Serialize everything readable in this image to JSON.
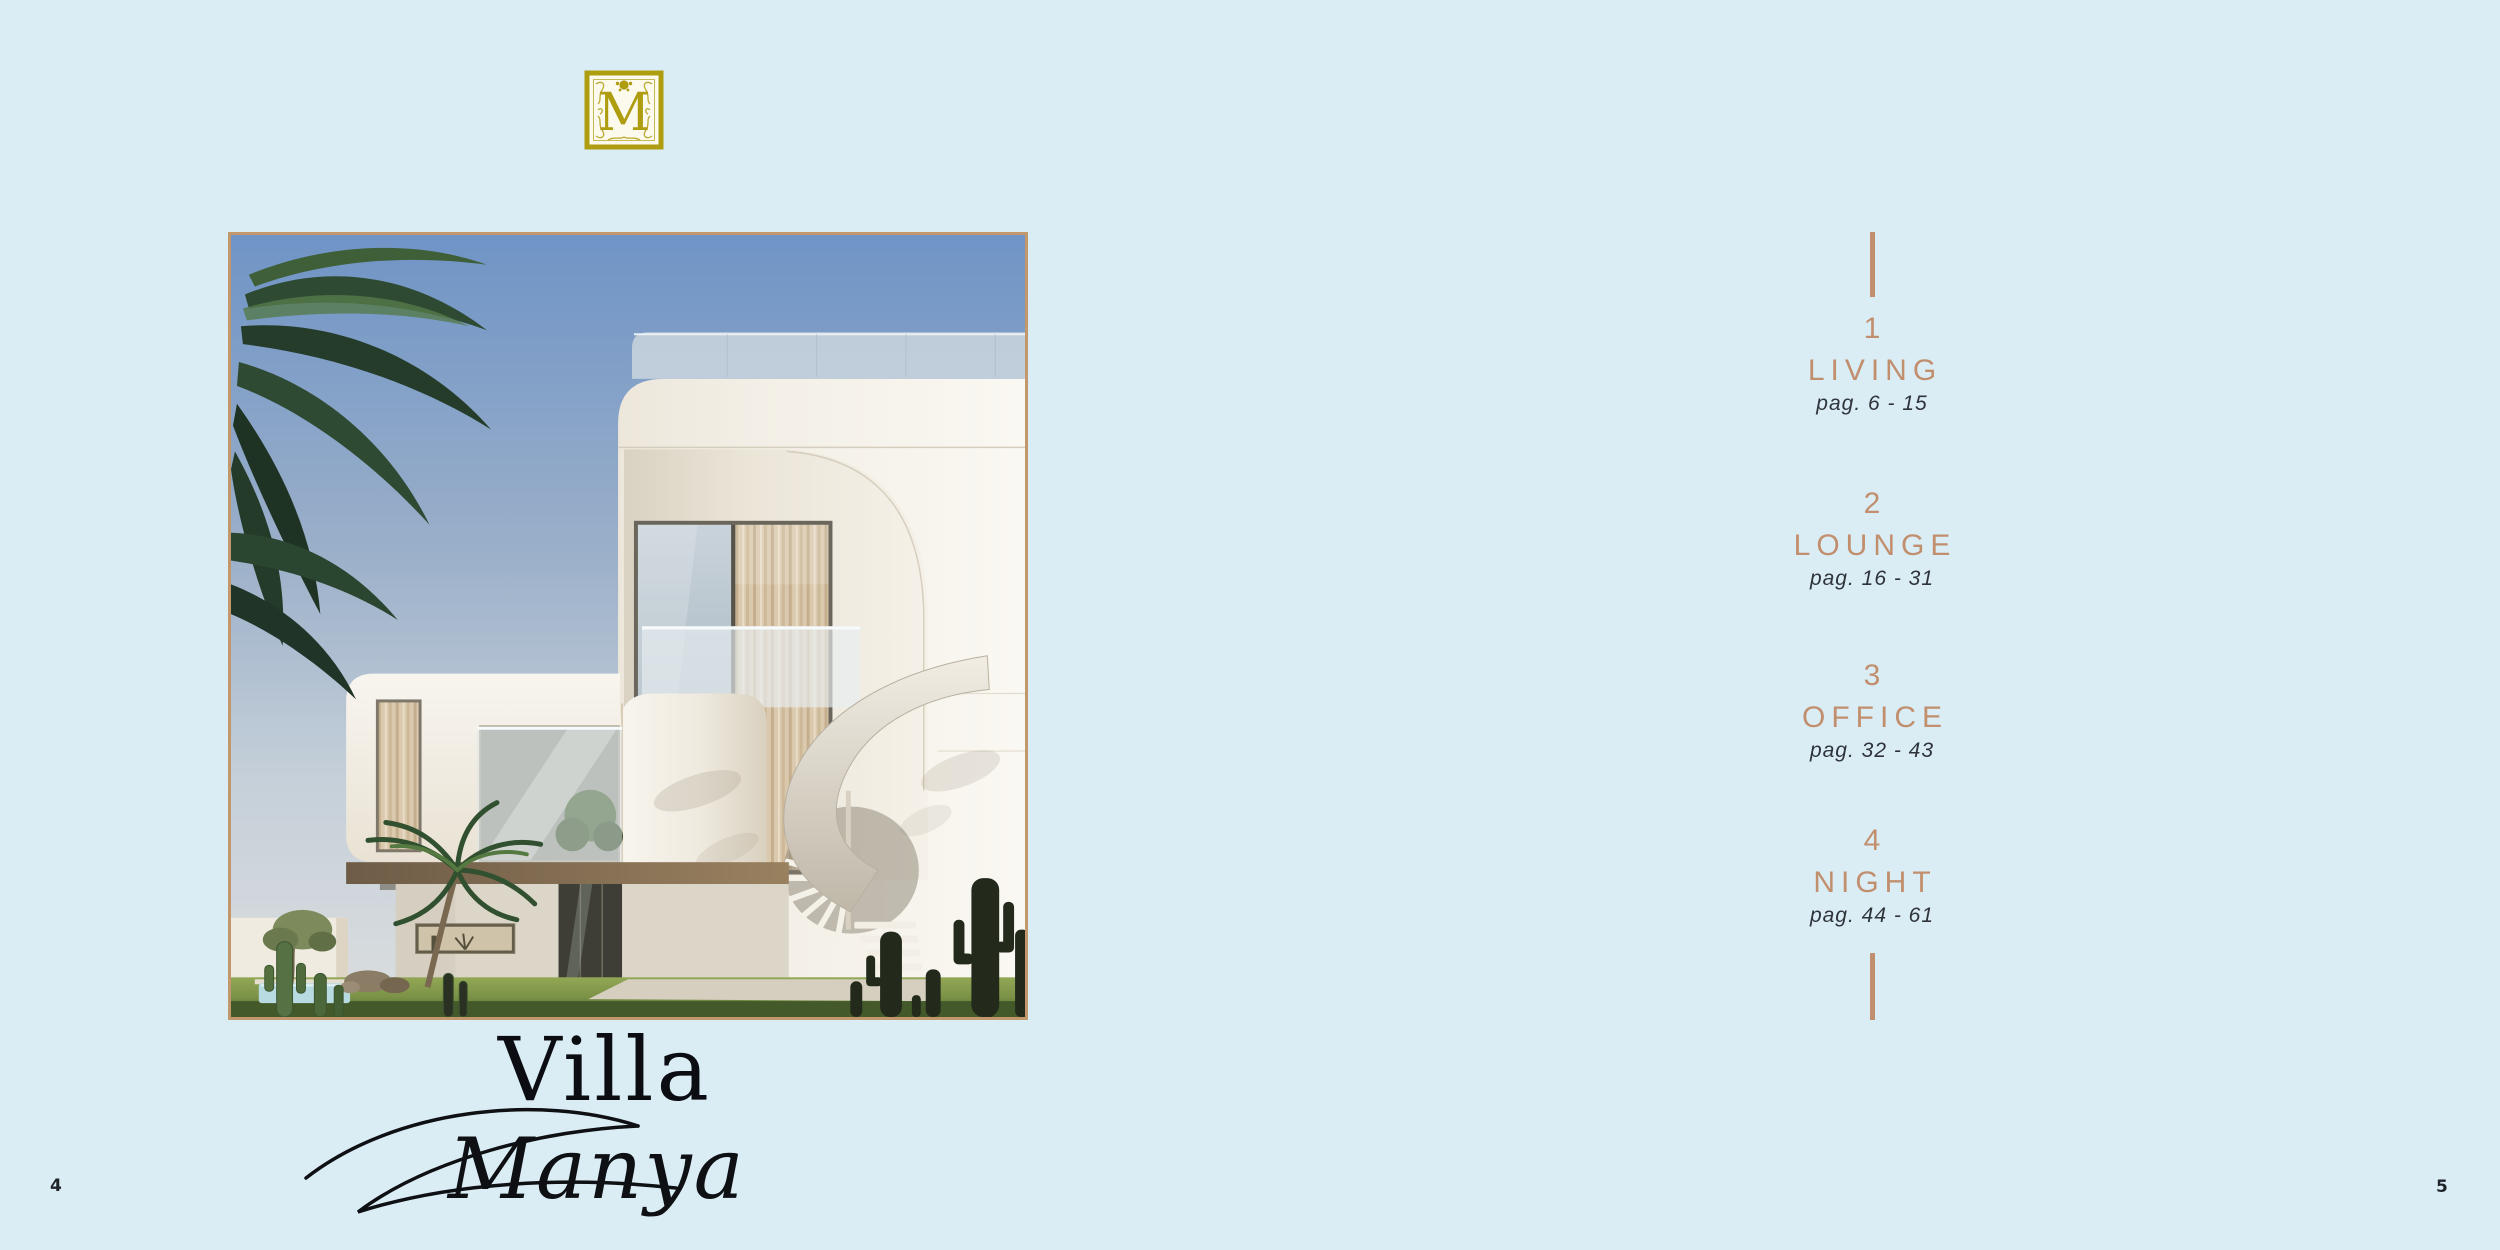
{
  "page": {
    "background_color": "#DAEDF5",
    "left_page_number": "4",
    "right_page_number": "5"
  },
  "brand": {
    "monogram_letter": "M",
    "monogram_color": "#AF9D10"
  },
  "cover": {
    "villa_word": "Villa",
    "villa_name": "Manya",
    "photo_alt": "Modern white villa with palm trees, spiral staircase and cacti",
    "frame_color": "#C2976C"
  },
  "toc": {
    "accent_color": "#C28F6E",
    "text_color": "#2F343A",
    "items": [
      {
        "number": "1",
        "title": "LIVING",
        "pages": "pag. 6 - 15"
      },
      {
        "number": "2",
        "title": "LOUNGE",
        "pages": "pag. 16 - 31"
      },
      {
        "number": "3",
        "title": "OFFICE",
        "pages": "pag. 32 - 43"
      },
      {
        "number": "4",
        "title": "NIGHT",
        "pages": "pag. 44 - 61"
      }
    ]
  }
}
